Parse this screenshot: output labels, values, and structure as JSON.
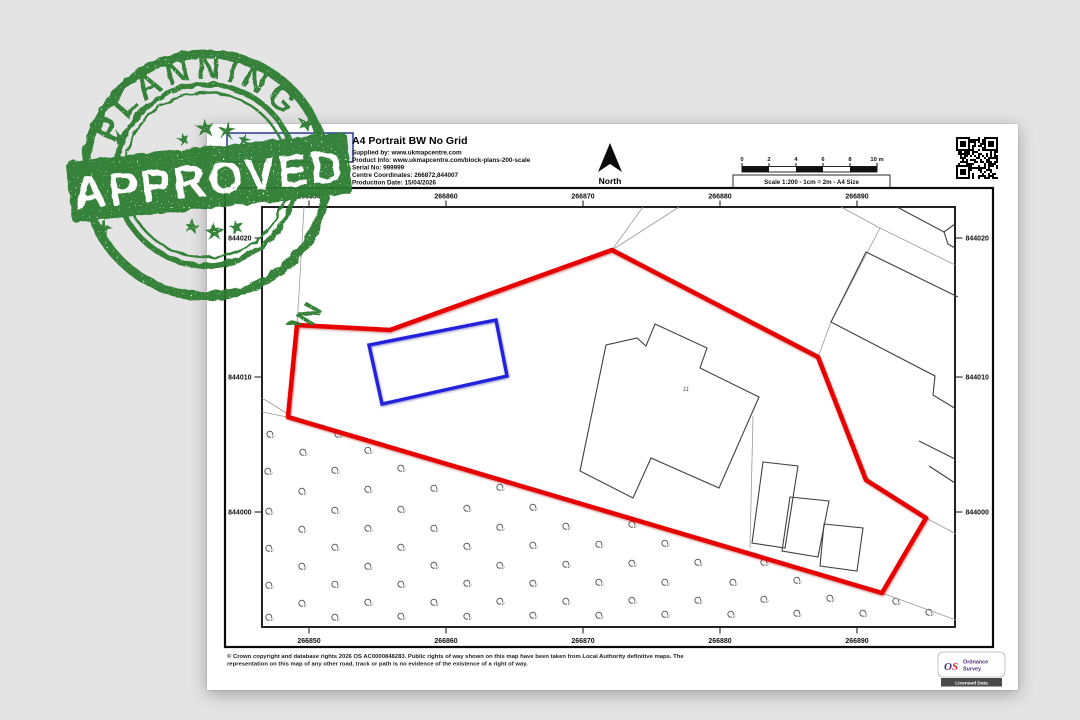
{
  "stamp": {
    "top_text": "PLANNING",
    "banner_text": "APPROVED",
    "bottom_text": "APPLICATION",
    "color": "#2e7d32"
  },
  "header": {
    "title": "A4 Portrait BW No Grid",
    "supplied_by": "Supplied by: www.ukmapcentre.com",
    "product_info": "Product Info: www.ukmapcentre.com/block-plans-200-scale",
    "serial_no": "Serial No: 999999",
    "centre_coordinates": "Centre Coordinates: 266872,844007",
    "production_date": "Production Date: 15/04/2026"
  },
  "north_label": "North",
  "scale_bar": {
    "tick_labels": [
      "0",
      "2",
      "4",
      "6",
      "8",
      "10 m"
    ],
    "caption": "Scale 1:200 - 1cm = 2m - A4 Size"
  },
  "map": {
    "eastings": {
      "labels": [
        "266850",
        "266860",
        "266870",
        "266880",
        "266890"
      ],
      "x": [
        309,
        446,
        583,
        720,
        857
      ]
    },
    "northings": {
      "labels": [
        "844020",
        "844010",
        "844000"
      ],
      "y": [
        238,
        377,
        512
      ]
    },
    "building_label": "11",
    "layers": [
      {
        "name": "track-edge-1",
        "cls": "thin",
        "closed": false,
        "points": "643,207 612,250"
      },
      {
        "name": "track-edge-2",
        "cls": "thin",
        "closed": false,
        "points": "679,207 612,250"
      },
      {
        "name": "parcel-line-left",
        "cls": "thin",
        "closed": false,
        "points": "304,207 297,327"
      },
      {
        "name": "track-edge-3",
        "cls": "thin",
        "closed": false,
        "points": "262,398 288,414"
      },
      {
        "name": "track-edge-4",
        "cls": "thin",
        "closed": false,
        "points": "262,412 287,417"
      },
      {
        "name": "parcel-line-topright",
        "cls": "thin",
        "closed": false,
        "points": "841,207 880,228 955,265"
      },
      {
        "name": "parcel-line-topright-2",
        "cls": "thin",
        "closed": false,
        "points": "880,228 831,322"
      },
      {
        "name": "parcel-line-topright-3",
        "cls": "thin",
        "closed": false,
        "points": "818,357 831,322"
      },
      {
        "name": "parcel-line-right-1",
        "cls": "thin",
        "closed": false,
        "points": "926,518 956,534"
      },
      {
        "name": "parcel-line-right-2",
        "cls": "thin",
        "closed": false,
        "points": "882,593 956,620"
      },
      {
        "name": "fence-line-outbuildings",
        "cls": "thin",
        "closed": false,
        "points": "753,416 750,548"
      },
      {
        "name": "building-main",
        "cls": "bld",
        "closed": true,
        "points": "655,324 707,348 700,368 759,397 719,488 651,458 633,498 580,471 606,345 637,338 646,346"
      },
      {
        "name": "outbuilding-1",
        "cls": "bld",
        "closed": true,
        "points": "763,462 798,466 785,548 752,543"
      },
      {
        "name": "outbuilding-2",
        "cls": "bld",
        "closed": true,
        "points": "790,497 829,501 818,557 782,551"
      },
      {
        "name": "outbuilding-3",
        "cls": "bld",
        "closed": true,
        "points": "824,524 863,528 857,571 820,566"
      },
      {
        "name": "neighbour-building-ne",
        "cls": "bld",
        "closed": false,
        "points": "958,297 866,252 831,322 935,376 933,395 956,409"
      },
      {
        "name": "neighbour-building-corner-1",
        "cls": "bld",
        "closed": false,
        "points": "897,207 944,232 955,224"
      },
      {
        "name": "neighbour-building-corner-2",
        "cls": "bld",
        "closed": false,
        "points": "944,232 948,244 955,248"
      },
      {
        "name": "neighbour-building-e-1",
        "cls": "bld",
        "closed": false,
        "points": "919,441 955,459"
      },
      {
        "name": "neighbour-building-e-2",
        "cls": "bld",
        "closed": false,
        "points": "929,466 955,483"
      },
      {
        "name": "site-boundary-red",
        "cls": "red",
        "closed": true,
        "points": "612,250 818,357 866,480 926,518 882,593 288,417 297,325 390,330"
      },
      {
        "name": "proposal-rectangle-blue",
        "cls": "blue",
        "closed": true,
        "points": "369,345 496,320 507,376 382,404"
      }
    ],
    "vegetation": [
      [
        270,
        434
      ],
      [
        338,
        434
      ],
      [
        303,
        452
      ],
      [
        368,
        450
      ],
      [
        268,
        471
      ],
      [
        335,
        470
      ],
      [
        401,
        468
      ],
      [
        302,
        491
      ],
      [
        368,
        489
      ],
      [
        434,
        488
      ],
      [
        500,
        487
      ],
      [
        269,
        511
      ],
      [
        335,
        510
      ],
      [
        401,
        509
      ],
      [
        467,
        508
      ],
      [
        533,
        507
      ],
      [
        302,
        529
      ],
      [
        368,
        528
      ],
      [
        434,
        528
      ],
      [
        500,
        527
      ],
      [
        566,
        526
      ],
      [
        632,
        524
      ],
      [
        269,
        548
      ],
      [
        335,
        547
      ],
      [
        401,
        547
      ],
      [
        467,
        546
      ],
      [
        533,
        545
      ],
      [
        599,
        544
      ],
      [
        665,
        543
      ],
      [
        302,
        566
      ],
      [
        368,
        566
      ],
      [
        434,
        565
      ],
      [
        500,
        565
      ],
      [
        566,
        564
      ],
      [
        632,
        563
      ],
      [
        698,
        562
      ],
      [
        764,
        562
      ],
      [
        269,
        585
      ],
      [
        335,
        584
      ],
      [
        401,
        584
      ],
      [
        467,
        583
      ],
      [
        533,
        583
      ],
      [
        599,
        582
      ],
      [
        665,
        582
      ],
      [
        733,
        582
      ],
      [
        797,
        580
      ],
      [
        302,
        603
      ],
      [
        368,
        602
      ],
      [
        434,
        602
      ],
      [
        500,
        601
      ],
      [
        566,
        601
      ],
      [
        632,
        600
      ],
      [
        698,
        600
      ],
      [
        764,
        599
      ],
      [
        830,
        598
      ],
      [
        896,
        601
      ],
      [
        269,
        617
      ],
      [
        335,
        617
      ],
      [
        401,
        616
      ],
      [
        467,
        616
      ],
      [
        533,
        615
      ],
      [
        599,
        615
      ],
      [
        665,
        614
      ],
      [
        731,
        614
      ],
      [
        797,
        613
      ],
      [
        863,
        613
      ],
      [
        929,
        612
      ]
    ]
  },
  "footer": {
    "copyright_line1": "© Crown copyright and database rights 2026 OS AC0000848283. Public rights of way shown on this map have been taken from Local Authority definitive maps. The",
    "copyright_line2": "representation on this map of any other road, track or path is no evidence of the existence of a right of way.",
    "os": {
      "brand_o": "O",
      "brand_s": "S",
      "line1": "Ordnance",
      "line2": "Survey",
      "badge": "Licensed Data"
    }
  },
  "colors": {
    "background": "#e4e4e4",
    "paper": "#ffffff",
    "stamp_green": "#2e7d32",
    "boundary_red": "#e60000",
    "proposal_blue": "#2222dd",
    "os_purple": "#4f2d7f",
    "os_red": "#d81e3f"
  }
}
